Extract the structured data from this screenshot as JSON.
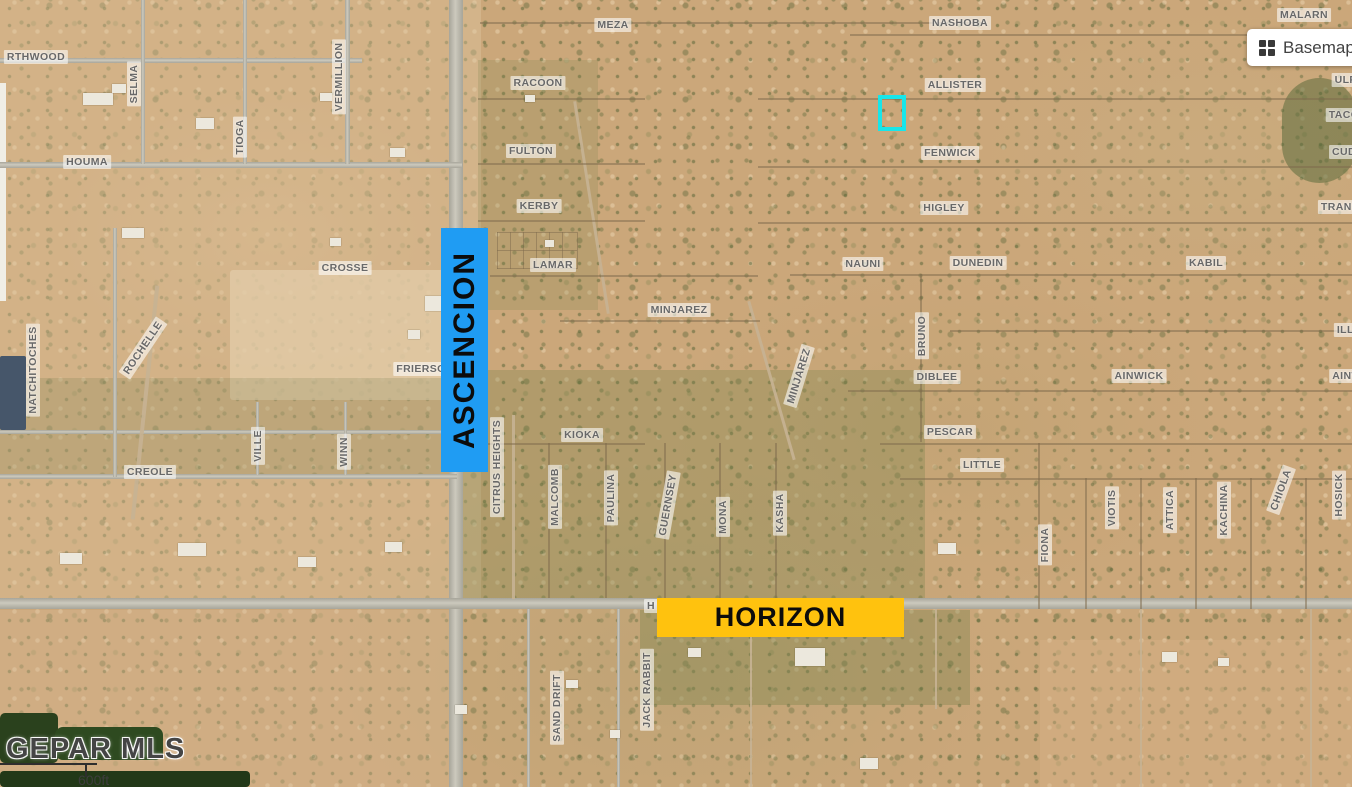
{
  "controls": {
    "basemap": {
      "label": "Basemap",
      "icon": "grid-icon"
    }
  },
  "watermark": {
    "text": "GEPAR MLS"
  },
  "scalebar": {
    "text": "600ft"
  },
  "map": {
    "colors": {
      "ascencion_bg": "#1f9cf3",
      "horizon_bg": "#ffc20e",
      "highlight": "#17e6ea"
    },
    "overlays": {
      "ascencion": {
        "text": "ASCENCION",
        "x": 441,
        "y": 228,
        "w": 47,
        "h": 244
      },
      "horizon": {
        "text": "HORIZON",
        "x": 657,
        "y": 598,
        "w": 247,
        "h": 39
      }
    },
    "highlight": {
      "x": 878,
      "y": 95,
      "w": 20,
      "h": 28
    },
    "street_labels": [
      {
        "text": "RTHWOOD",
        "x": 36,
        "y": 57
      },
      {
        "text": "SELMA",
        "x": 134,
        "y": 84,
        "rot": -90
      },
      {
        "text": "TIOGA",
        "x": 240,
        "y": 137,
        "rot": -90
      },
      {
        "text": "VERMILLION",
        "x": 339,
        "y": 77,
        "rot": -90
      },
      {
        "text": "HOUMA",
        "x": 87,
        "y": 162
      },
      {
        "text": "MEZA",
        "x": 613,
        "y": 25
      },
      {
        "text": "RACOON",
        "x": 538,
        "y": 83
      },
      {
        "text": "FULTON",
        "x": 531,
        "y": 151
      },
      {
        "text": "KERBY",
        "x": 539,
        "y": 206
      },
      {
        "text": "NASHOBA",
        "x": 960,
        "y": 23
      },
      {
        "text": "ALLISTER",
        "x": 955,
        "y": 85
      },
      {
        "text": "FENWICK",
        "x": 950,
        "y": 153
      },
      {
        "text": "HIGLEY",
        "x": 944,
        "y": 208
      },
      {
        "text": "MALARN",
        "x": 1304,
        "y": 15
      },
      {
        "text": "ULR",
        "x": 1346,
        "y": 80
      },
      {
        "text": "TACO",
        "x": 1344,
        "y": 115
      },
      {
        "text": "CUD",
        "x": 1344,
        "y": 152
      },
      {
        "text": "TRANS",
        "x": 1340,
        "y": 207
      },
      {
        "text": "CROSSE",
        "x": 345,
        "y": 268
      },
      {
        "text": "LAMAR",
        "x": 553,
        "y": 265
      },
      {
        "text": "NAUNI",
        "x": 863,
        "y": 264
      },
      {
        "text": "DUNEDIN",
        "x": 978,
        "y": 263
      },
      {
        "text": "KABIL",
        "x": 1206,
        "y": 263
      },
      {
        "text": "MINJAREZ",
        "x": 679,
        "y": 310
      },
      {
        "text": "BRUNO",
        "x": 922,
        "y": 336,
        "rot": -90
      },
      {
        "text": "ILLI",
        "x": 1347,
        "y": 330
      },
      {
        "text": "FRIERSON",
        "x": 425,
        "y": 369
      },
      {
        "text": "MINJAREZ",
        "x": 799,
        "y": 376,
        "rot": -73
      },
      {
        "text": "DIBLEE",
        "x": 937,
        "y": 377
      },
      {
        "text": "AINWICK",
        "x": 1139,
        "y": 376
      },
      {
        "text": "AINW",
        "x": 1347,
        "y": 376
      },
      {
        "text": "NATCHITOCHES",
        "x": 33,
        "y": 370,
        "rot": -90
      },
      {
        "text": "ROCHELLE",
        "x": 143,
        "y": 348,
        "rot": -56
      },
      {
        "text": "KIOKA",
        "x": 582,
        "y": 435
      },
      {
        "text": "PESCAR",
        "x": 950,
        "y": 432
      },
      {
        "text": "LITTLE",
        "x": 982,
        "y": 465
      },
      {
        "text": "CREOLE",
        "x": 150,
        "y": 472
      },
      {
        "text": "VILLE",
        "x": 258,
        "y": 446,
        "rot": -90
      },
      {
        "text": "WINN",
        "x": 344,
        "y": 452,
        "rot": -90
      },
      {
        "text": "CITRUS HEIGHTS",
        "x": 497,
        "y": 467,
        "rot": -90
      },
      {
        "text": "MALCOMB",
        "x": 555,
        "y": 497,
        "rot": -90
      },
      {
        "text": "PAULINA",
        "x": 611,
        "y": 498,
        "rot": -90
      },
      {
        "text": "GUERNSEY",
        "x": 668,
        "y": 505,
        "rot": -80
      },
      {
        "text": "MONA",
        "x": 723,
        "y": 517,
        "rot": -90
      },
      {
        "text": "KASHA",
        "x": 780,
        "y": 513,
        "rot": -90
      },
      {
        "text": "FIONA",
        "x": 1045,
        "y": 545,
        "rot": -90
      },
      {
        "text": "VIOTIS",
        "x": 1112,
        "y": 508,
        "rot": -90
      },
      {
        "text": "ATTICA",
        "x": 1170,
        "y": 510,
        "rot": -90
      },
      {
        "text": "KACHINA",
        "x": 1224,
        "y": 510,
        "rot": -90
      },
      {
        "text": "CHIOLA",
        "x": 1281,
        "y": 490,
        "rot": -70
      },
      {
        "text": "HOSICK",
        "x": 1339,
        "y": 495,
        "rot": -90
      },
      {
        "text": "SAND DRIFT",
        "x": 557,
        "y": 708,
        "rot": -90
      },
      {
        "text": "JACK RABBIT",
        "x": 647,
        "y": 690,
        "rot": -90
      },
      {
        "text": "H",
        "x": 651,
        "y": 606
      }
    ],
    "roads": [
      {
        "t": "pv",
        "x": 449,
        "y": 0,
        "w": 14,
        "h": 787
      },
      {
        "t": "ph",
        "x": 0,
        "y": 598,
        "w": 1352,
        "h": 11
      },
      {
        "t": "ph",
        "x": 0,
        "y": 162,
        "w": 462,
        "h": 6
      },
      {
        "t": "ph",
        "x": 0,
        "y": 58,
        "w": 362,
        "h": 5
      },
      {
        "t": "ph",
        "x": 0,
        "y": 474,
        "w": 457,
        "h": 5
      },
      {
        "t": "ph",
        "x": 0,
        "y": 430,
        "w": 458,
        "h": 4
      },
      {
        "t": "pv",
        "x": 141,
        "y": 0,
        "w": 4,
        "h": 164
      },
      {
        "t": "pv",
        "x": 243,
        "y": 0,
        "w": 4,
        "h": 164
      },
      {
        "t": "pv",
        "x": 345,
        "y": 0,
        "w": 5,
        "h": 164
      },
      {
        "t": "pv",
        "x": 113,
        "y": 228,
        "w": 4,
        "h": 249
      },
      {
        "t": "pv",
        "x": 256,
        "y": 402,
        "w": 3,
        "h": 73
      },
      {
        "t": "pv",
        "x": 344,
        "y": 402,
        "w": 3,
        "h": 73
      },
      {
        "t": "dv",
        "x": 512,
        "y": 415,
        "w": 3,
        "h": 184
      },
      {
        "t": "pv",
        "x": 527,
        "y": 609,
        "w": 3,
        "h": 178
      },
      {
        "t": "pv",
        "x": 617,
        "y": 609,
        "w": 3,
        "h": 178
      },
      {
        "t": "dv",
        "x": 750,
        "y": 609,
        "w": 2,
        "h": 178
      },
      {
        "t": "dv",
        "x": 935,
        "y": 609,
        "w": 2,
        "h": 100
      },
      {
        "t": "dv",
        "x": 1140,
        "y": 609,
        "w": 2,
        "h": 178
      },
      {
        "t": "dv",
        "x": 1310,
        "y": 609,
        "w": 2,
        "h": 178
      },
      {
        "t": "dv",
        "x": 143,
        "y": 285,
        "w": 4,
        "h": 235,
        "rot": 6
      },
      {
        "t": "dv",
        "x": 770,
        "y": 298,
        "w": 3,
        "h": 165,
        "rot": -16
      },
      {
        "t": "dv",
        "x": 590,
        "y": 100,
        "w": 3,
        "h": 215,
        "rot": -9
      },
      {
        "t": "lot",
        "x": 480,
        "y": 22,
        "w": 505,
        "h": 2
      },
      {
        "t": "lot",
        "x": 850,
        "y": 34,
        "w": 502,
        "h": 2
      },
      {
        "t": "lot",
        "x": 478,
        "y": 98,
        "w": 167,
        "h": 2
      },
      {
        "t": "lot",
        "x": 758,
        "y": 98,
        "w": 594,
        "h": 2
      },
      {
        "t": "lot",
        "x": 478,
        "y": 163,
        "w": 167,
        "h": 2
      },
      {
        "t": "lot",
        "x": 758,
        "y": 166,
        "w": 594,
        "h": 2
      },
      {
        "t": "lot",
        "x": 478,
        "y": 220,
        "w": 167,
        "h": 2
      },
      {
        "t": "lot",
        "x": 758,
        "y": 222,
        "w": 594,
        "h": 2
      },
      {
        "t": "lot",
        "x": 490,
        "y": 275,
        "w": 268,
        "h": 2
      },
      {
        "t": "lot",
        "x": 790,
        "y": 274,
        "w": 562,
        "h": 2
      },
      {
        "t": "lot",
        "x": 560,
        "y": 320,
        "w": 200,
        "h": 2
      },
      {
        "t": "lot",
        "x": 920,
        "y": 274,
        "w": 2,
        "h": 168
      },
      {
        "t": "lot",
        "x": 950,
        "y": 330,
        "w": 402,
        "h": 2
      },
      {
        "t": "lot",
        "x": 848,
        "y": 390,
        "w": 504,
        "h": 2
      },
      {
        "t": "lot",
        "x": 880,
        "y": 443,
        "w": 472,
        "h": 2
      },
      {
        "t": "lot",
        "x": 900,
        "y": 478,
        "w": 452,
        "h": 2
      },
      {
        "t": "lot",
        "x": 478,
        "y": 443,
        "w": 167,
        "h": 2
      },
      {
        "t": "lot",
        "x": 548,
        "y": 443,
        "w": 2,
        "h": 155
      },
      {
        "t": "lot",
        "x": 605,
        "y": 443,
        "w": 2,
        "h": 155
      },
      {
        "t": "lot",
        "x": 664,
        "y": 443,
        "w": 2,
        "h": 155
      },
      {
        "t": "lot",
        "x": 719,
        "y": 443,
        "w": 2,
        "h": 155
      },
      {
        "t": "lot",
        "x": 775,
        "y": 443,
        "w": 2,
        "h": 155
      },
      {
        "t": "lot",
        "x": 1038,
        "y": 443,
        "w": 2,
        "h": 166
      },
      {
        "t": "lot",
        "x": 1085,
        "y": 478,
        "w": 2,
        "h": 131
      },
      {
        "t": "lot",
        "x": 1140,
        "y": 478,
        "w": 2,
        "h": 131
      },
      {
        "t": "lot",
        "x": 1195,
        "y": 478,
        "w": 2,
        "h": 131
      },
      {
        "t": "lot",
        "x": 1250,
        "y": 478,
        "w": 2,
        "h": 131
      },
      {
        "t": "lot",
        "x": 1305,
        "y": 478,
        "w": 2,
        "h": 131
      },
      {
        "t": "lot",
        "x": 497,
        "y": 232,
        "w": 80,
        "h": 1
      },
      {
        "t": "lot",
        "x": 497,
        "y": 250,
        "w": 80,
        "h": 1
      },
      {
        "t": "lot",
        "x": 497,
        "y": 268,
        "w": 80,
        "h": 1
      },
      {
        "t": "lot",
        "x": 497,
        "y": 232,
        "w": 1,
        "h": 37
      },
      {
        "t": "lot",
        "x": 510,
        "y": 232,
        "w": 1,
        "h": 37
      },
      {
        "t": "lot",
        "x": 523,
        "y": 232,
        "w": 1,
        "h": 37
      },
      {
        "t": "lot",
        "x": 536,
        "y": 232,
        "w": 1,
        "h": 37
      },
      {
        "t": "lot",
        "x": 549,
        "y": 232,
        "w": 1,
        "h": 37
      },
      {
        "t": "lot",
        "x": 562,
        "y": 232,
        "w": 1,
        "h": 37
      },
      {
        "t": "lot",
        "x": 577,
        "y": 232,
        "w": 1,
        "h": 37
      }
    ],
    "patches": [
      {
        "x": 0,
        "y": 0,
        "w": 452,
        "h": 598,
        "c": "rgba(224,196,158,0.38)"
      },
      {
        "x": 455,
        "y": 0,
        "w": 26,
        "h": 598,
        "c": "rgba(223,201,162,0.4)"
      },
      {
        "x": 230,
        "y": 270,
        "w": 225,
        "h": 130,
        "c": "rgba(227,205,170,0.72)",
        "r": 3
      },
      {
        "x": 478,
        "y": 60,
        "w": 120,
        "h": 250,
        "c": "rgba(122,132,78,0.22)"
      },
      {
        "x": 455,
        "y": 370,
        "w": 470,
        "h": 228,
        "c": "rgba(104,122,66,0.26)"
      },
      {
        "x": 0,
        "y": 378,
        "w": 452,
        "h": 98,
        "c": "rgba(108,122,70,0.2)"
      },
      {
        "x": 1282,
        "y": 78,
        "w": 75,
        "h": 105,
        "c": "rgba(58,88,40,0.42)",
        "r": 45
      },
      {
        "x": 640,
        "y": 610,
        "w": 330,
        "h": 95,
        "c": "rgba(98,118,62,0.28)"
      },
      {
        "x": 0,
        "y": 610,
        "w": 460,
        "h": 177,
        "c": "rgba(218,186,148,0.35)"
      },
      {
        "x": 1040,
        "y": 640,
        "w": 312,
        "h": 147,
        "c": "rgba(214,178,136,0.4)"
      },
      {
        "x": 0,
        "y": 713,
        "w": 58,
        "h": 50,
        "c": "#2a411d",
        "r": 5
      },
      {
        "x": 55,
        "y": 727,
        "w": 108,
        "h": 33,
        "c": "#2e4a20",
        "r": 8
      },
      {
        "x": 0,
        "y": 771,
        "w": 250,
        "h": 16,
        "c": "#223818",
        "r": 4
      },
      {
        "x": 0,
        "y": 83,
        "w": 6,
        "h": 218,
        "c": "#f0eee6"
      },
      {
        "x": 0,
        "y": 356,
        "w": 26,
        "h": 74,
        "c": "#46566a",
        "r": 2
      }
    ],
    "buildings": [
      {
        "x": 83,
        "y": 93,
        "w": 30,
        "h": 12
      },
      {
        "x": 112,
        "y": 84,
        "w": 14,
        "h": 9
      },
      {
        "x": 196,
        "y": 118,
        "w": 18,
        "h": 11
      },
      {
        "x": 390,
        "y": 148,
        "w": 15,
        "h": 9
      },
      {
        "x": 320,
        "y": 93,
        "w": 12,
        "h": 8
      },
      {
        "x": 122,
        "y": 228,
        "w": 22,
        "h": 10
      },
      {
        "x": 330,
        "y": 238,
        "w": 11,
        "h": 8
      },
      {
        "x": 425,
        "y": 296,
        "w": 24,
        "h": 15
      },
      {
        "x": 408,
        "y": 330,
        "w": 12,
        "h": 9
      },
      {
        "x": 60,
        "y": 553,
        "w": 22,
        "h": 11
      },
      {
        "x": 178,
        "y": 543,
        "w": 28,
        "h": 13
      },
      {
        "x": 298,
        "y": 557,
        "w": 18,
        "h": 10
      },
      {
        "x": 385,
        "y": 542,
        "w": 17,
        "h": 10
      },
      {
        "x": 938,
        "y": 543,
        "w": 18,
        "h": 11
      },
      {
        "x": 795,
        "y": 648,
        "w": 30,
        "h": 18
      },
      {
        "x": 688,
        "y": 648,
        "w": 13,
        "h": 9
      },
      {
        "x": 1162,
        "y": 652,
        "w": 15,
        "h": 10
      },
      {
        "x": 1218,
        "y": 658,
        "w": 11,
        "h": 8
      },
      {
        "x": 860,
        "y": 758,
        "w": 18,
        "h": 11
      },
      {
        "x": 566,
        "y": 680,
        "w": 12,
        "h": 8
      },
      {
        "x": 610,
        "y": 730,
        "w": 10,
        "h": 8
      },
      {
        "x": 455,
        "y": 705,
        "w": 12,
        "h": 9
      },
      {
        "x": 525,
        "y": 95,
        "w": 10,
        "h": 7
      },
      {
        "x": 545,
        "y": 240,
        "w": 9,
        "h": 7
      }
    ]
  }
}
